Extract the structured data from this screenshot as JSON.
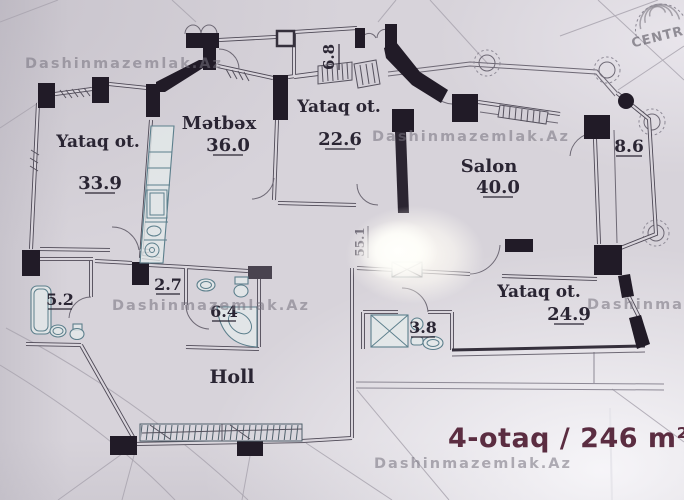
{
  "watermark": "Dashinmazemlak.Az",
  "stamp": "CENTRA",
  "title": "4-otaq / 246 m²",
  "rooms": [
    {
      "name": "Yataq ot.",
      "area": "33.9"
    },
    {
      "name": "Mətbəx",
      "area": "36.0"
    },
    {
      "name": "Yataq ot.",
      "area": "22.6"
    },
    {
      "name": "Salon",
      "area": "40.0"
    },
    {
      "name": "Yataq ot.",
      "area": "24.9"
    },
    {
      "name": "Holl",
      "area": ""
    }
  ],
  "annotations": [
    {
      "label": "6.8"
    },
    {
      "label": "8.6"
    },
    {
      "label": "5.2"
    },
    {
      "label": "2.7"
    },
    {
      "label": "6.4"
    },
    {
      "label": "3.8"
    },
    {
      "label": "55.1"
    }
  ],
  "colors": {
    "paper": "#d7d3da",
    "wall": "#211b27",
    "fixture": "#5c7f8c",
    "title": "#5b2d41",
    "watermark": "#76727e"
  }
}
